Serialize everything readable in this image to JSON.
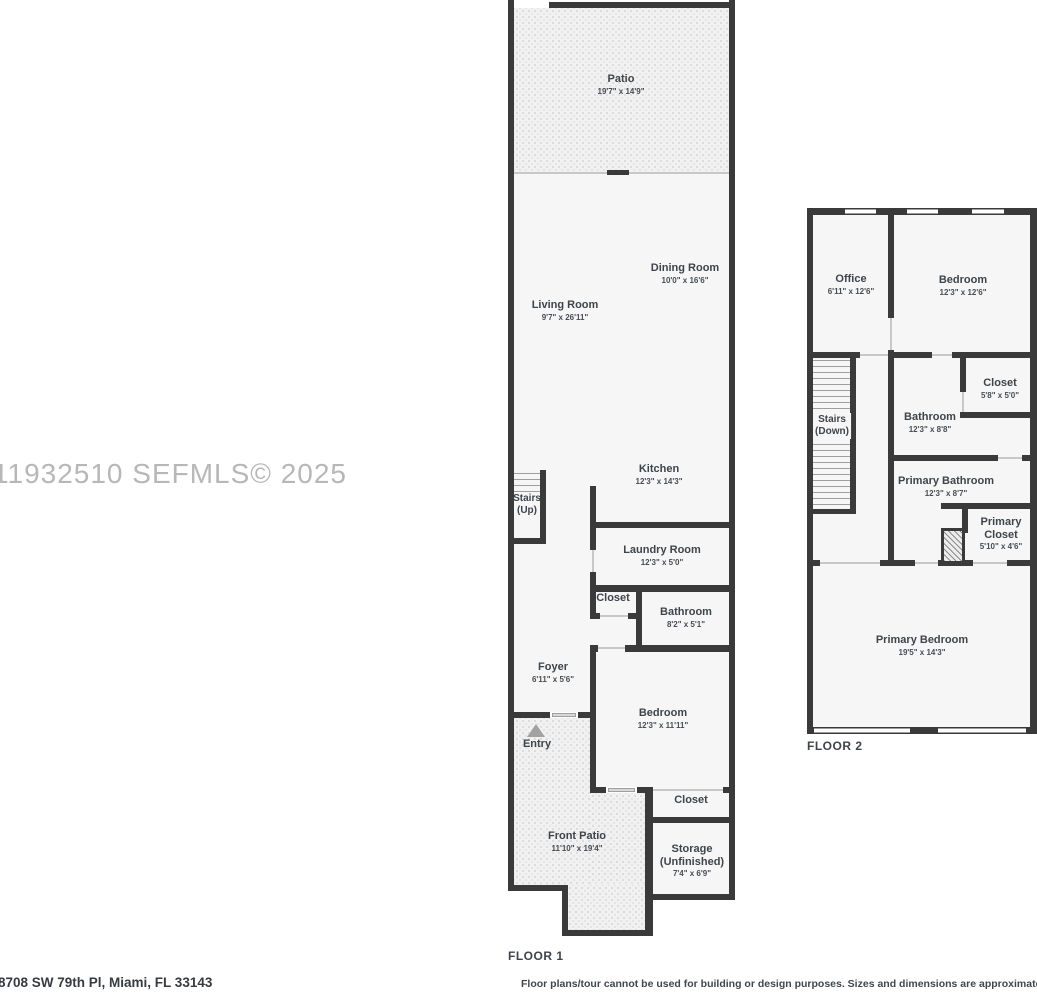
{
  "watermark": "11932510  SEFMLS© 2025",
  "address": "8708 SW 79th Pl, Miami, FL 33143",
  "disclaimer": "Floor plans/tour cannot be used for building or design purposes. Sizes and dimensions are approximate.",
  "colors": {
    "wall": "#3a3a3a",
    "floor": "#f6f6f6",
    "text": "#3e444b",
    "watermark": "#b7b7b7"
  },
  "floor1": {
    "label": "FLOOR 1",
    "rooms": {
      "patio": {
        "name": "Patio",
        "dims": "19'7\" x 14'9\""
      },
      "dining": {
        "name": "Dining Room",
        "dims": "10'0\" x 16'6\""
      },
      "living": {
        "name": "Living Room",
        "dims": "9'7\" x 26'11\""
      },
      "kitchen": {
        "name": "Kitchen",
        "dims": "12'3\" x 14'3\""
      },
      "stairs": {
        "name": "Stairs",
        "sub": "(Up)"
      },
      "laundry": {
        "name": "Laundry Room",
        "dims": "12'3\" x 5'0\""
      },
      "hall_closet": {
        "name": "Closet"
      },
      "bathroom": {
        "name": "Bathroom",
        "dims": "8'2\" x 5'1\""
      },
      "foyer": {
        "name": "Foyer",
        "dims": "6'11\" x 5'6\""
      },
      "entry": {
        "name": "Entry"
      },
      "bedroom": {
        "name": "Bedroom",
        "dims": "12'3\" x 11'11\""
      },
      "bedroom_closet": {
        "name": "Closet"
      },
      "front_patio": {
        "name": "Front Patio",
        "dims": "11'10\" x 19'4\""
      },
      "storage": {
        "name": "Storage",
        "sub": "(Unfinished)",
        "dims": "7'4\" x 6'9\""
      }
    }
  },
  "floor2": {
    "label": "FLOOR 2",
    "rooms": {
      "office": {
        "name": "Office",
        "dims": "6'11\" x 12'6\""
      },
      "bedroom": {
        "name": "Bedroom",
        "dims": "12'3\" x 12'6\""
      },
      "stairs": {
        "name": "Stairs",
        "sub": "(Down)"
      },
      "bathroom": {
        "name": "Bathroom",
        "dims": "12'3\" x 8'8\""
      },
      "closet": {
        "name": "Closet",
        "dims": "5'8\" x 5'0\""
      },
      "primary_bathroom": {
        "name": "Primary Bathroom",
        "dims": "12'3\" x 8'7\""
      },
      "primary_closet": {
        "name": "Primary Closet",
        "dims": "5'10\" x 4'6\""
      },
      "primary_bedroom": {
        "name": "Primary Bedroom",
        "dims": "19'5\" x 14'3\""
      }
    }
  }
}
